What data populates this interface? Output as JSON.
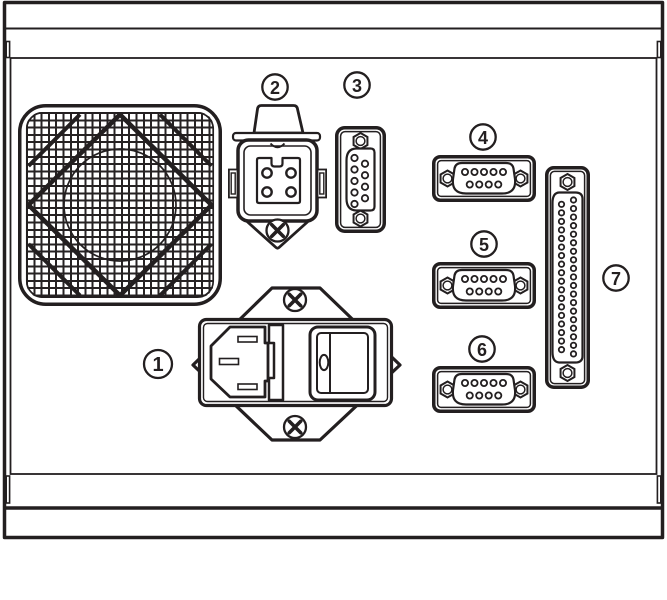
{
  "diagram": {
    "kind": "rear-panel-line-diagram",
    "background": "#ffffff",
    "line_color": "#231f20",
    "callouts": {
      "c1": {
        "label": "1",
        "component": "iec-power-inlet-module",
        "pins": 3
      },
      "c2": {
        "label": "2",
        "component": "square-power-connector",
        "pins": 4
      },
      "c3": {
        "label": "3",
        "component": "d-sub-9-connector-vertical",
        "pins": 9
      },
      "c4": {
        "label": "4",
        "component": "d-sub-9-connector",
        "pins": 9
      },
      "c5": {
        "label": "5",
        "component": "d-sub-9-connector",
        "pins": 9
      },
      "c6": {
        "label": "6",
        "component": "d-sub-9-connector",
        "pins": 9
      },
      "c7": {
        "label": "7",
        "component": "d-sub-37-connector-vertical",
        "pins": 37
      }
    },
    "unlabeled": {
      "fan": "fan-grille"
    }
  }
}
